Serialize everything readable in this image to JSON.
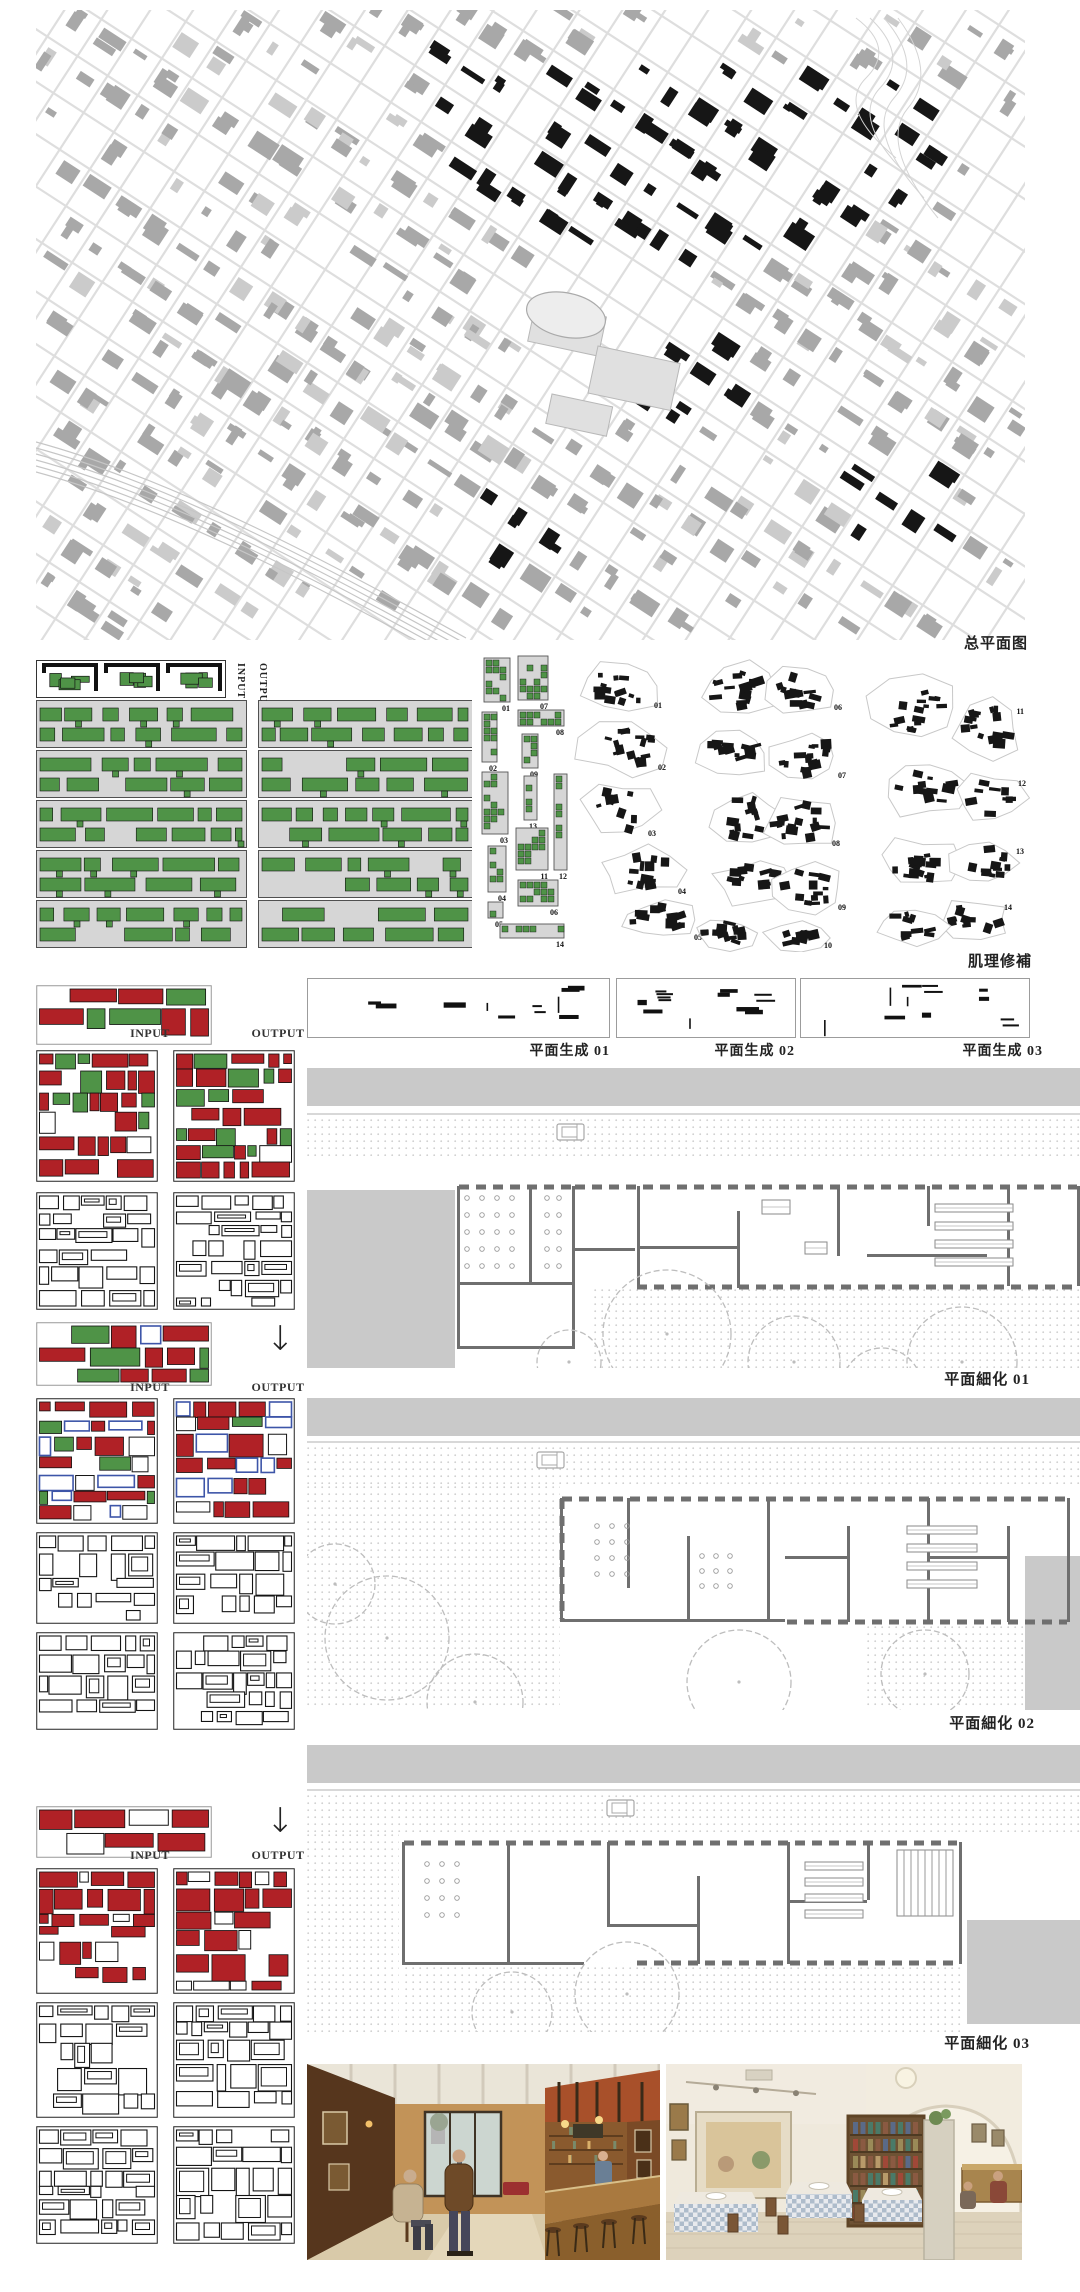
{
  "labels": {
    "site_plan": "总平面图",
    "texture_repair": "肌理修補",
    "input": "INPUT",
    "output": "OUTPUT",
    "plan_gen": [
      "平面生成 01",
      "平面生成 02",
      "平面生成 03"
    ],
    "plan_refine": [
      "平面細化 01",
      "平面細化 02",
      "平面細化 03"
    ]
  },
  "colors": {
    "green": "#4f9347",
    "red": "#b02126",
    "blue": "#3d55a8",
    "map_black": "#161616",
    "map_gray": "#a8a8a8",
    "panel_gray": "#d6d6d6",
    "band_gray": "#c9c9c9",
    "wall_gray": "#6f6f6f"
  },
  "strip_items": [
    {
      "n": "01",
      "x": 6,
      "y": 8,
      "w": 26,
      "h": 44
    },
    {
      "n": "02",
      "x": 4,
      "y": 62,
      "w": 15,
      "h": 50
    },
    {
      "n": "03",
      "x": 4,
      "y": 122,
      "w": 26,
      "h": 62
    },
    {
      "n": "04",
      "x": 10,
      "y": 196,
      "w": 18,
      "h": 46
    },
    {
      "n": "05",
      "x": 10,
      "y": 252,
      "w": 15,
      "h": 16
    },
    {
      "n": "07",
      "x": 40,
      "y": 6,
      "w": 30,
      "h": 44
    },
    {
      "n": "08",
      "x": 40,
      "y": 60,
      "w": 46,
      "h": 16
    },
    {
      "n": "09",
      "x": 44,
      "y": 84,
      "w": 16,
      "h": 34
    },
    {
      "n": "13",
      "x": 46,
      "y": 126,
      "w": 13,
      "h": 44
    },
    {
      "n": "11",
      "x": 38,
      "y": 178,
      "w": 32,
      "h": 42
    },
    {
      "n": "06",
      "x": 40,
      "y": 230,
      "w": 40,
      "h": 26
    },
    {
      "n": "12",
      "x": 76,
      "y": 124,
      "w": 13,
      "h": 96
    },
    {
      "n": "14",
      "x": 22,
      "y": 274,
      "w": 64,
      "h": 14
    }
  ],
  "cluster_items": [
    {
      "cx": 48,
      "cy": 38,
      "rx": 40,
      "ry": 26,
      "n": "01",
      "nx": 88,
      "ny": 60
    },
    {
      "cx": 50,
      "cy": 100,
      "rx": 42,
      "ry": 26,
      "n": "02",
      "nx": 92,
      "ny": 122
    },
    {
      "cx": 44,
      "cy": 162,
      "rx": 36,
      "ry": 28,
      "n": "03",
      "nx": 82,
      "ny": 188
    },
    {
      "cx": 66,
      "cy": 222,
      "rx": 40,
      "ry": 22,
      "n": "04",
      "nx": 112,
      "ny": 246
    },
    {
      "cx": 84,
      "cy": 272,
      "rx": 36,
      "ry": 18,
      "n": "05",
      "nx": 128,
      "ny": 292
    },
    {
      "cx": 168,
      "cy": 40,
      "rx": 40,
      "ry": 26,
      "n": ""
    },
    {
      "cx": 160,
      "cy": 105,
      "rx": 34,
      "ry": 24,
      "n": ""
    },
    {
      "cx": 172,
      "cy": 170,
      "rx": 38,
      "ry": 26,
      "n": ""
    },
    {
      "cx": 180,
      "cy": 235,
      "rx": 36,
      "ry": 22,
      "n": ""
    },
    {
      "cx": 150,
      "cy": 285,
      "rx": 30,
      "ry": 16,
      "n": ""
    },
    {
      "cx": 228,
      "cy": 42,
      "rx": 34,
      "ry": 24,
      "n": "06",
      "nx": 268,
      "ny": 62
    },
    {
      "cx": 232,
      "cy": 108,
      "rx": 36,
      "ry": 24,
      "n": "07",
      "nx": 272,
      "ny": 130
    },
    {
      "cx": 226,
      "cy": 175,
      "rx": 34,
      "ry": 26,
      "n": "08",
      "nx": 266,
      "ny": 198
    },
    {
      "cx": 234,
      "cy": 240,
      "rx": 34,
      "ry": 22,
      "n": "09",
      "nx": 272,
      "ny": 262
    },
    {
      "cx": 222,
      "cy": 290,
      "rx": 30,
      "ry": 14,
      "n": "10",
      "nx": 258,
      "ny": 300
    },
    {
      "cx": 340,
      "cy": 60,
      "rx": 44,
      "ry": 30,
      "n": ""
    },
    {
      "cx": 350,
      "cy": 140,
      "rx": 40,
      "ry": 28,
      "n": ""
    },
    {
      "cx": 344,
      "cy": 215,
      "rx": 38,
      "ry": 24,
      "n": ""
    },
    {
      "cx": 412,
      "cy": 80,
      "rx": 34,
      "ry": 28,
      "n": "11",
      "nx": 450,
      "ny": 66
    },
    {
      "cx": 416,
      "cy": 150,
      "rx": 32,
      "ry": 24,
      "n": "12",
      "nx": 452,
      "ny": 138
    },
    {
      "cx": 410,
      "cy": 215,
      "rx": 34,
      "ry": 24,
      "n": "13",
      "nx": 450,
      "ny": 206
    },
    {
      "cx": 400,
      "cy": 272,
      "rx": 36,
      "ry": 18,
      "n": "14",
      "nx": 438,
      "ny": 262
    },
    {
      "cx": 336,
      "cy": 278,
      "rx": 34,
      "ry": 18,
      "n": ""
    }
  ]
}
